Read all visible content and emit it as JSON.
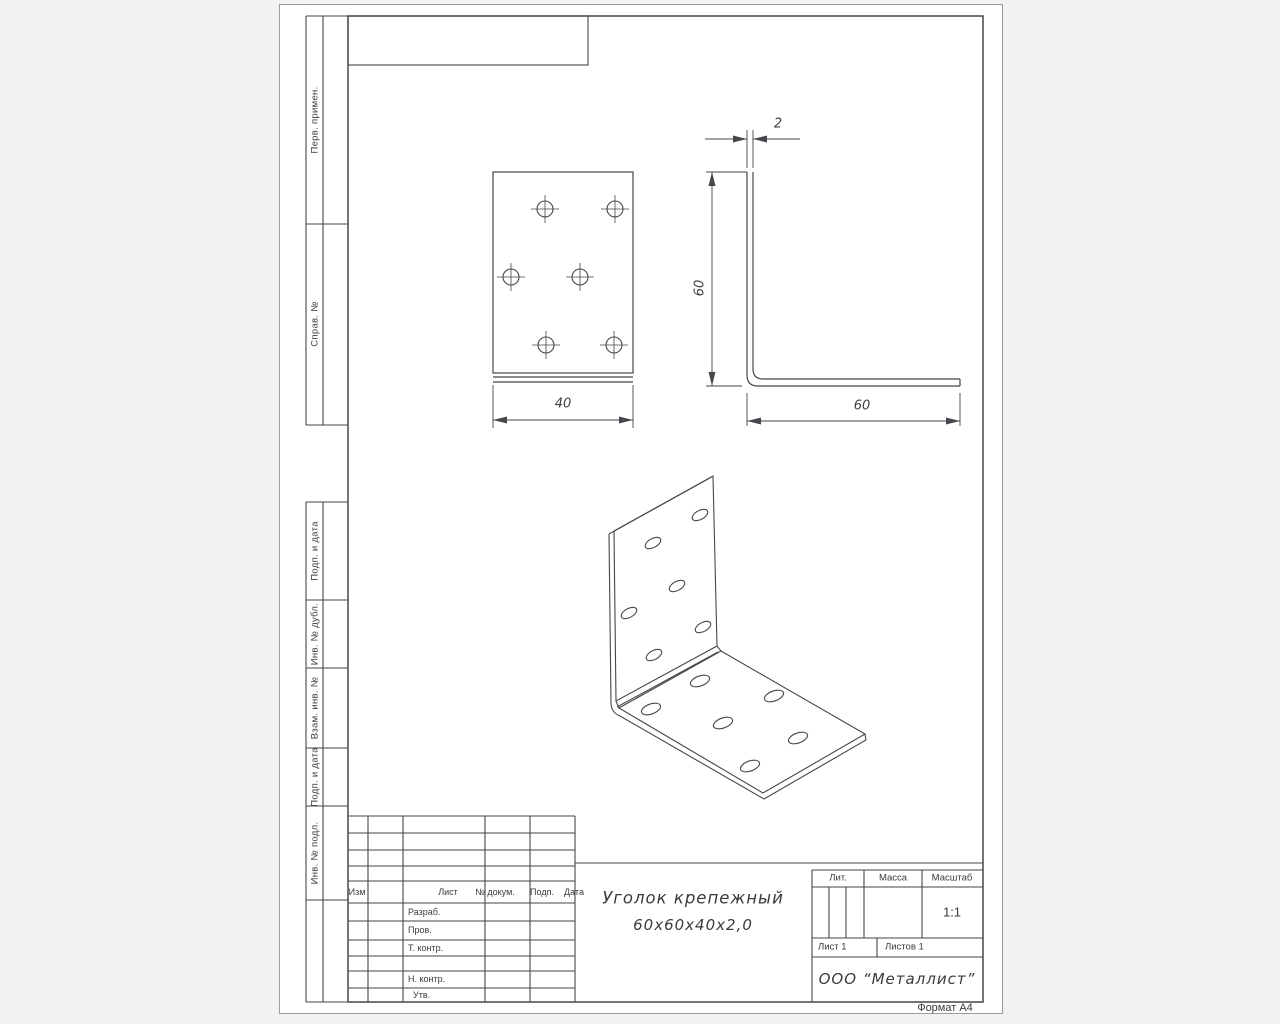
{
  "sheet": {
    "format_note": "Формат А4"
  },
  "margin_labels": [
    "Перв. примен.",
    "Справ. №",
    "Подп. и дата",
    "Инв. № дубл.",
    "Взам. инв. №",
    "Подп. и дата",
    "Инв. № подл."
  ],
  "drawing": {
    "part_title_line1": "Уголок крепежный",
    "part_title_line2": "60х60х40х2,0",
    "dimensions": {
      "flange_width": "40",
      "thickness": "2",
      "leg_height": "60",
      "leg_length": "60"
    }
  },
  "title_block": {
    "revision_header": {
      "izm": "Изм",
      "list": "Лист",
      "doc": "№ докум.",
      "sign": "Подп.",
      "date": "Дата"
    },
    "roles": [
      "Разраб.",
      "Пров.",
      "Т. контр.",
      "Н. контр.",
      "Утв."
    ],
    "lit_label": "Лит.",
    "mass_label": "Масса",
    "scale_label": "Масштаб",
    "scale_value": "1:1",
    "sheet_label": "Лист 1",
    "sheets_label": "Листов 1",
    "company": "ООО “Металлист”"
  }
}
